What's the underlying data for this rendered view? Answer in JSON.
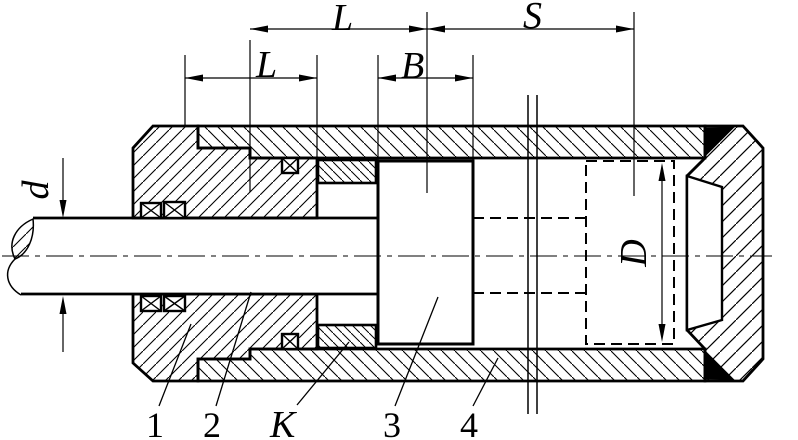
{
  "drawing": {
    "background_color": "#ffffff",
    "line_color": "#000000",
    "dim_labels": {
      "upper_length": "L",
      "lower_length": "L",
      "stroke_length": "S",
      "piston_width": "B",
      "rod_diameter": "d",
      "bore_diameter": "D"
    },
    "part_labels": {
      "end_cap": "1",
      "piston_rod": "2",
      "spacer_ring": "K",
      "piston": "3",
      "cylinder_barrel": "4"
    }
  }
}
